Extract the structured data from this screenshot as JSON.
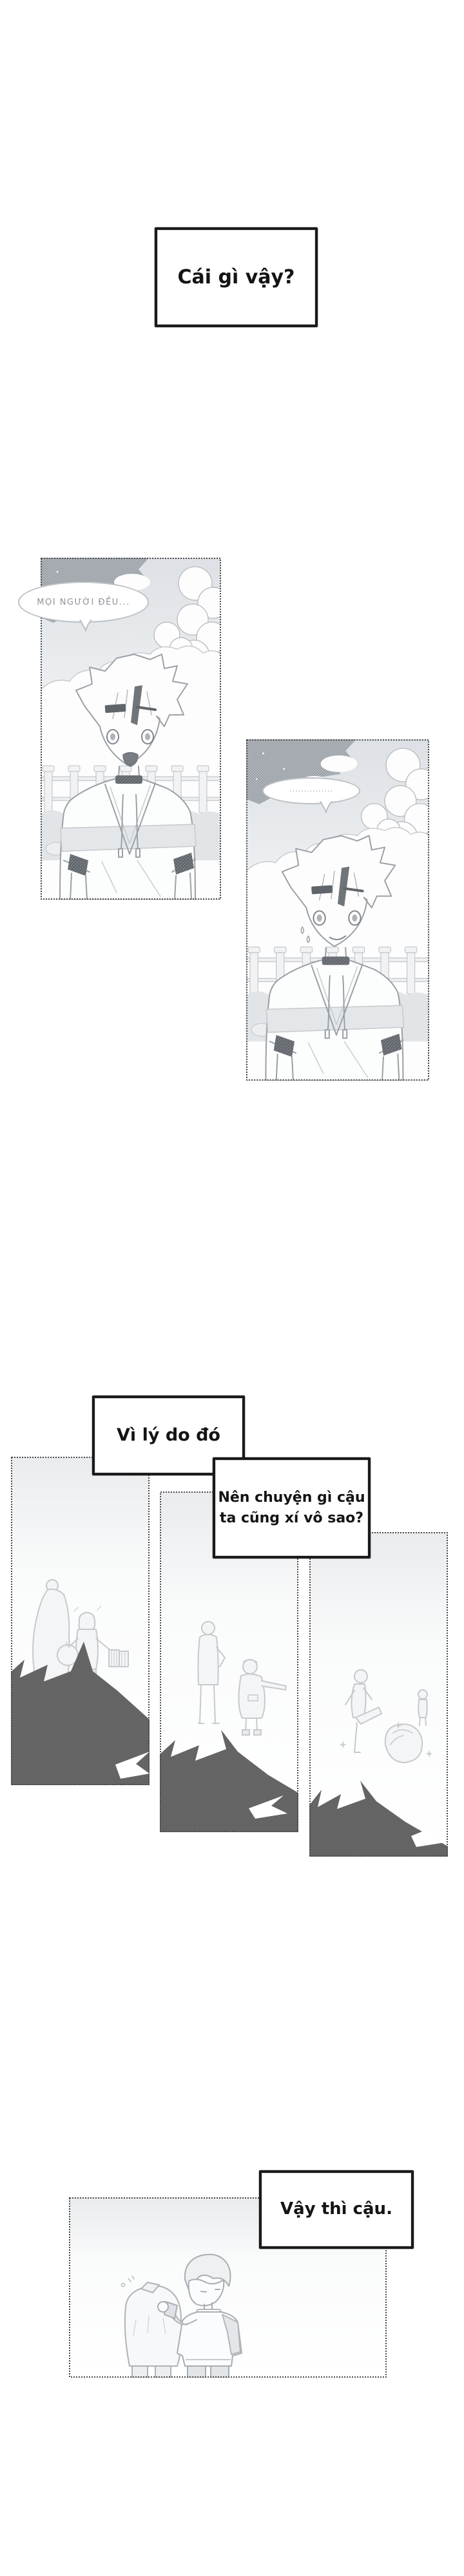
{
  "page": {
    "type": "webtoon-comic-page",
    "language": "Vietnamese",
    "background": "#ffffff"
  },
  "captions": {
    "box1": {
      "text": "Cái gì vậy?"
    },
    "box2": {
      "text": "Vì lý do đó"
    },
    "box3": {
      "line1": "Nên chuyện gì cậu",
      "line2": "ta cũng xí vô sao?"
    },
    "box4": {
      "text": "Vậy thì cậu."
    }
  },
  "speech_bubbles": {
    "bubble1": {
      "text": "MỌI NGƯỜI ĐỀU..."
    },
    "bubble2": {
      "text": "···············"
    }
  },
  "colors": {
    "caption_ink": "#141414",
    "caption_border": "#1a1a1a",
    "panel_border": "#4a4a4a",
    "line_art": "#9ba1a7",
    "line_art_faint": "#c6cacd",
    "silhouette_dark": "#5d5d5d",
    "halftone_grey": "#9aa0a6",
    "bubble_outline": "#bcc0c5",
    "bubble_text": "#8e939a"
  }
}
